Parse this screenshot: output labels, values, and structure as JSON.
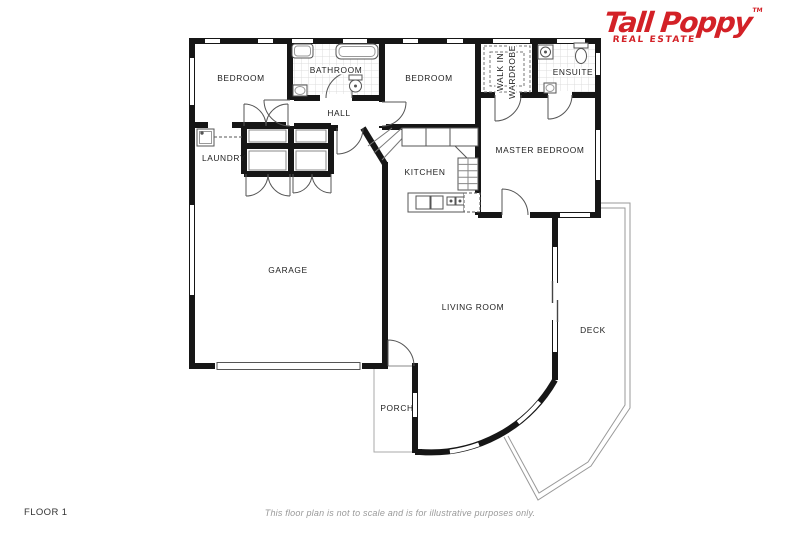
{
  "logo": {
    "brand": "Tall Poppy",
    "tagline": "REAL ESTATE",
    "trademark": "TM",
    "brand_color": "#d32127"
  },
  "plan": {
    "wall_color": "#161616",
    "rooms": {
      "bedroom1": "BEDROOM",
      "bathroom": "BATHROOM",
      "bedroom2": "BEDROOM",
      "walk_in_line1": "WALK IN",
      "walk_in_line2": "WARDROBE",
      "ensuite": "ENSUITE",
      "master_bedroom": "MASTER BEDROOM",
      "hall": "HALL",
      "laundry": "LAUNDRY",
      "kitchen": "KITCHEN",
      "garage": "GARAGE",
      "living_room": "LIVING ROOM",
      "deck": "DECK",
      "porch": "PORCH"
    }
  },
  "footer": {
    "floor_label": "FLOOR 1",
    "disclaimer": "This floor plan is not to scale and is for illustrative purposes only."
  }
}
